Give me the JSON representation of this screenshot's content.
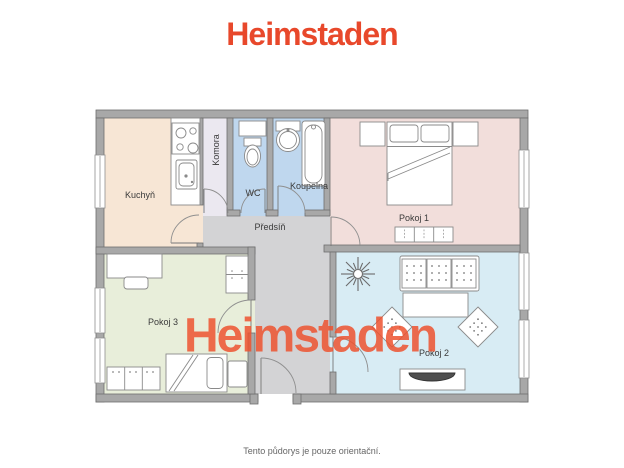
{
  "header": {
    "logo": "Heimstaden"
  },
  "watermark": {
    "text": "Heimstaden"
  },
  "footer": {
    "disclaimer": "Tento půdorys je pouze orientační."
  },
  "palette": {
    "brand_orange": "#e8482b",
    "watermark_orange": "#ee5330",
    "wall_gray": "#a8a8a8",
    "wall_outline": "#6e6e6e",
    "furniture_outline": "#8a8a8a"
  },
  "floor_plan": {
    "rooms": [
      {
        "id": "kuchyn",
        "label": "Kuchyň",
        "color": "#f7e6d5"
      },
      {
        "id": "komora",
        "label": "Komora",
        "color": "#ebe8f0"
      },
      {
        "id": "wc",
        "label": "WC",
        "color": "#bfd7ee"
      },
      {
        "id": "koupelna",
        "label": "Koupelna",
        "color": "#bfd7ee"
      },
      {
        "id": "predsin",
        "label": "Předsíň",
        "color": "#d3d3d5"
      },
      {
        "id": "pokoj1",
        "label": "Pokoj 1",
        "color": "#f2dedb"
      },
      {
        "id": "pokoj2",
        "label": "Pokoj 2",
        "color": "#d8ecf4"
      },
      {
        "id": "pokoj3",
        "label": "Pokoj 3",
        "color": "#e8eeda"
      }
    ]
  }
}
